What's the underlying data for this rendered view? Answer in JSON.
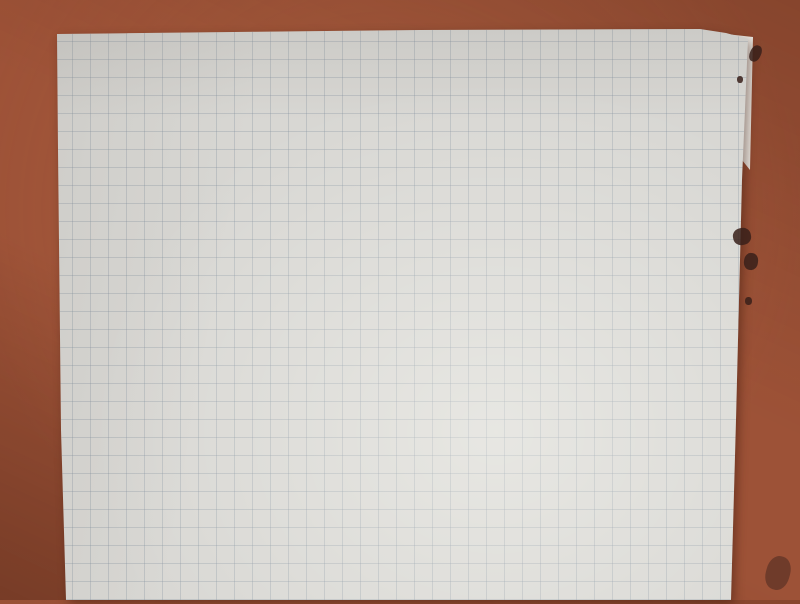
{
  "colors": {
    "table": "#9d5237",
    "paper": "#d8d7d3",
    "grid_line": "#808e9c",
    "pencil": "#56504a"
  },
  "schematic": {
    "top": {
      "source": {
        "main": "400V",
        "sub": "0"
      },
      "r1": {
        "main": "R",
        "sub": "1"
      },
      "tube": {
        "line1": "Geiger",
        "line2": "Müller",
        "line3": "trubice"
      },
      "p_half": "P/2",
      "feedback_r": "R",
      "opamp_plus": "+"
    },
    "bottom": {
      "ucc": {
        "main": "U",
        "sub": "cc"
      },
      "rc_left": {
        "main": "R",
        "sub": "c"
      },
      "rb_left": {
        "main": "R",
        "sub": "B"
      },
      "cap": "C",
      "rb_right": {
        "main": "R",
        "sub": "B"
      },
      "rc_right": {
        "main": "R",
        "sub": "c"
      },
      "counter_box": {
        "line1": "pulse",
        "line2": "counter",
        "line3": "Pic",
        "line4": "clock"
      }
    }
  }
}
